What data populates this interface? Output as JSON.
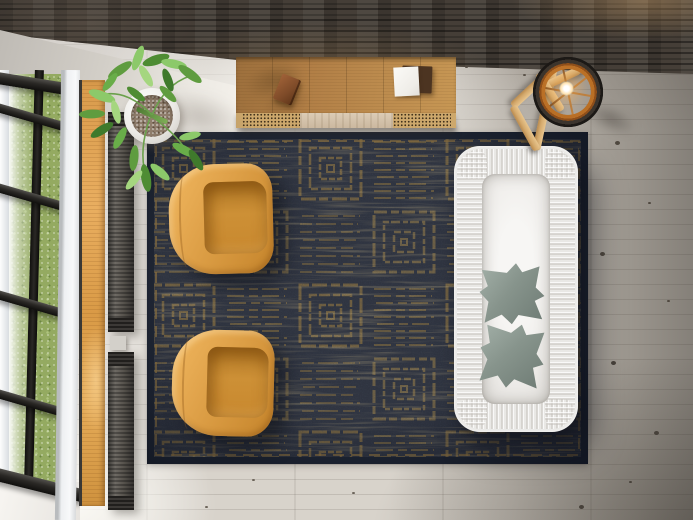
{
  "scene": {
    "label": "Top-down 3D render of a living room: white sofa with sage pillows, two cognac leather armchairs on a charcoal-and-gold geometric rug, oak sideboard against a dark textured wall, ring floor lamp on a wooden tripod stool, potted plant, black-framed window with lawn view, wooden sill and radiators, grey oak plank floor",
    "view": "bird's-eye interior",
    "text_content": "none"
  },
  "objects": [
    {
      "id": "back-wall",
      "label": "dark textured stone wall band"
    },
    {
      "id": "concrete-ledge",
      "label": "light concrete ledge above window"
    },
    {
      "id": "window",
      "label": "black-framed window with green lawn outside"
    },
    {
      "id": "window-sill",
      "label": "warm oak window sill plank"
    },
    {
      "id": "radiator-upper",
      "label": "dark wall radiator, upper"
    },
    {
      "id": "radiator-lower",
      "label": "dark wall radiator, lower"
    },
    {
      "id": "potted-plant",
      "label": "green plant in round white pot"
    },
    {
      "id": "sideboard",
      "label": "oak sideboard with cane door panels"
    },
    {
      "id": "book-brown",
      "label": "small brown book on sideboard"
    },
    {
      "id": "book-white",
      "label": "white book on dark folio"
    },
    {
      "id": "area-rug",
      "label": "charcoal rug with gold concentric-square pattern"
    },
    {
      "id": "armchair-top",
      "label": "cognac leather armchair (upper)"
    },
    {
      "id": "armchair-bottom",
      "label": "cognac leather armchair (lower)"
    },
    {
      "id": "sofa",
      "label": "white slipcovered sofa"
    },
    {
      "id": "sofa-pillow-1",
      "label": "sage green cushion"
    },
    {
      "id": "sofa-pillow-2",
      "label": "sage green cushion"
    },
    {
      "id": "floor-lamp",
      "label": "lit ring floor lamp on wooden tripod stool"
    },
    {
      "id": "wood-floor",
      "label": "grey washed oak plank floor"
    }
  ],
  "palette": {
    "wall-dark": "#453e37",
    "ledge": "#bdb9b3",
    "floor-mid": "#d8d3cb",
    "rug-base": "#2f3440",
    "rug-gold": "#a8853f",
    "rug-border-dark": "#1f2634",
    "rug-border-gold": "#8f7340",
    "chair-rim": "#eeb45c",
    "chair-mid": "#d6973e",
    "chair-seat": "#b57c28",
    "sofa-base": "#e9e8e5",
    "sofa-inner": "#f7f6f4",
    "pillow-light": "#a3b0a8",
    "pillow-dark": "#87948c",
    "console-wood-1": "#9c6f3c",
    "console-wood-2": "#c79754",
    "cane": "#cda86c",
    "book-brown": "#7d4a28",
    "book-dark": "#4c3421",
    "paper-white": "#efede8",
    "sill-1": "#d89a4b",
    "sill-2": "#cf923e",
    "frame-dark": "#2a2825",
    "frame-white": "#d9dde1",
    "grass-1": "#94aa61",
    "grass-2": "#aec47e",
    "radiator": "#6e6a64",
    "pot-white": "#eceae6",
    "soil": "#8f7d6c",
    "leaf-dark": "#3f7a2c",
    "leaf-mid": "#5f9c3f",
    "leaf-light": "#8cc96a",
    "stem": "#6aa04b",
    "wood-light-1": "#e8c58e",
    "wood-light-2": "#b98a4e",
    "lamp-orange": "#b96f26",
    "lamp-dark": "#3b342d",
    "bulb-glow": "#ffe2ae"
  }
}
